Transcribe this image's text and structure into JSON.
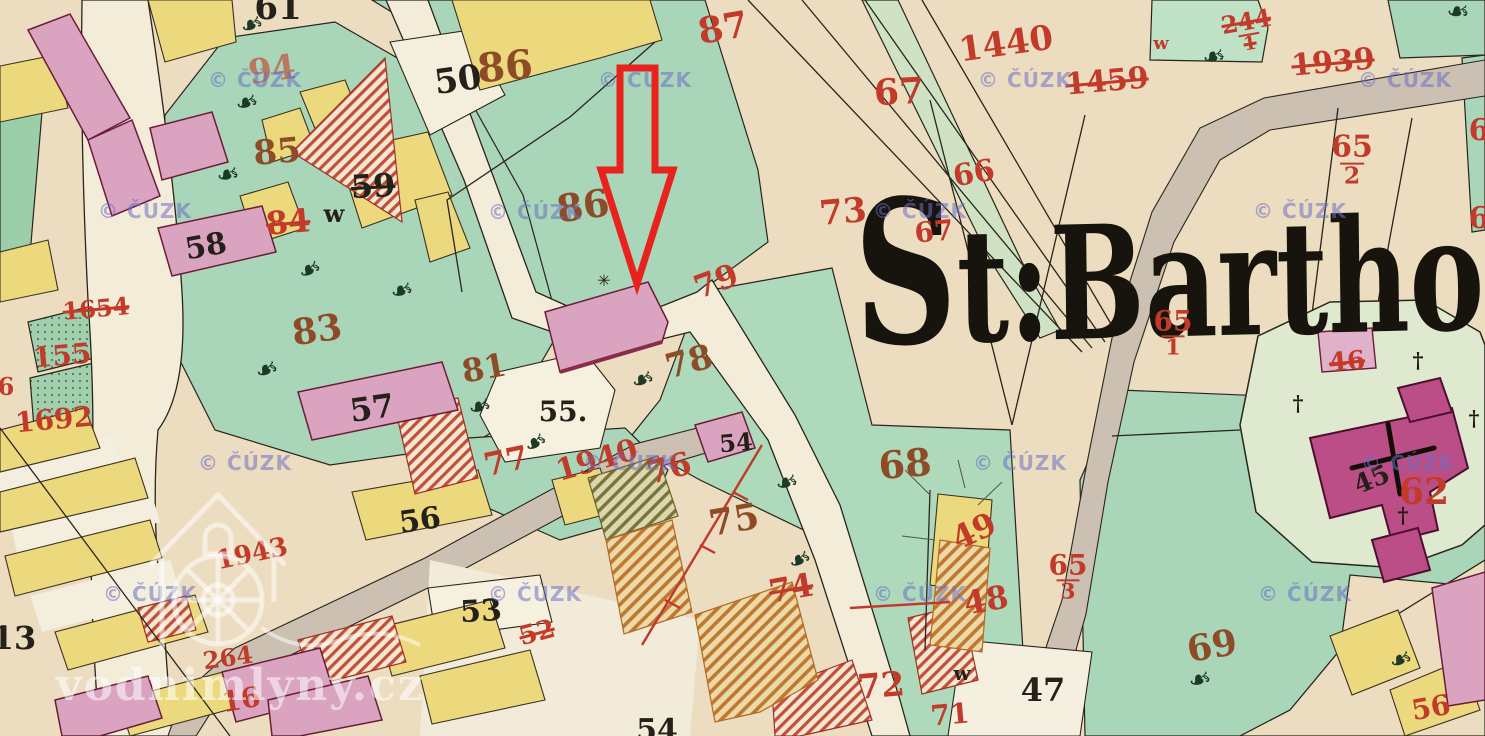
{
  "map": {
    "place_label": "St:Bartho",
    "copyright_watermark": "© ČÚZK",
    "site_watermark": "vodnimlyny.cz",
    "colors": {
      "paper": "#ecdcc0",
      "road_cream": "#f3ecd9",
      "road_grey": "#cbc0b1",
      "meadow_green": "#a9d6b8",
      "churchyard_green": "#dfe9cf",
      "parcel_yellow": "#ecd97d",
      "building_pink": "#daa3c0",
      "church_magenta": "#bb4e86",
      "number_red": "#c23a2a",
      "number_brown": "#8e4b28",
      "ink_black": "#24201a",
      "arrow_red": "#e8231d",
      "watermark_purple": "rgba(108,112,198,0.55)",
      "watermark_white": "rgba(255,255,255,0.55)"
    },
    "arrow": {
      "points": "620,68 655,68 655,170 673,170 637,284 601,170 620,170",
      "color": "#e8231d",
      "stroke_width": 7
    },
    "sun_symbol": {
      "x": 604,
      "y": 281
    },
    "icons": {
      "tree_glyph": "❧",
      "cross_glyph": "†",
      "sun_glyph": "✳"
    },
    "watermark_positions": [
      [
        255,
        80
      ],
      [
        645,
        80
      ],
      [
        1025,
        80
      ],
      [
        1405,
        80
      ],
      [
        145,
        211
      ],
      [
        535,
        212
      ],
      [
        920,
        211
      ],
      [
        1300,
        211
      ],
      [
        245,
        463
      ],
      [
        630,
        463
      ],
      [
        1020,
        463
      ],
      [
        1408,
        463
      ],
      [
        150,
        594
      ],
      [
        535,
        594
      ],
      [
        920,
        594
      ],
      [
        1305,
        594
      ]
    ],
    "labels": [
      {
        "text": "61",
        "x": 278,
        "y": 8,
        "color": "black",
        "size": 34,
        "rot": 0
      },
      {
        "text": "50",
        "x": 458,
        "y": 80,
        "color": "black",
        "size": 34,
        "rot": -8
      },
      {
        "text": "94",
        "x": 272,
        "y": 70,
        "color": "red",
        "size": 34,
        "rot": -8,
        "fade": true
      },
      {
        "text": "85",
        "x": 277,
        "y": 152,
        "color": "brown",
        "size": 34,
        "rot": -5
      },
      {
        "text": "59",
        "x": 373,
        "y": 186,
        "color": "black",
        "size": 32,
        "rot": -3,
        "strike": true
      },
      {
        "text": "84",
        "x": 288,
        "y": 222,
        "color": "red",
        "size": 32,
        "rot": -5,
        "strike": true
      },
      {
        "text": "w",
        "x": 334,
        "y": 214,
        "color": "black",
        "size": 24,
        "rot": 0
      },
      {
        "text": "58",
        "x": 206,
        "y": 247,
        "color": "black",
        "size": 30,
        "rot": -10
      },
      {
        "text": "83",
        "x": 317,
        "y": 330,
        "color": "brown",
        "size": 36,
        "rot": -8
      },
      {
        "text": "81",
        "x": 484,
        "y": 368,
        "color": "brown",
        "size": 32,
        "rot": -10
      },
      {
        "text": "57",
        "x": 372,
        "y": 408,
        "color": "black",
        "size": 32,
        "rot": -8
      },
      {
        "text": "55.",
        "x": 563,
        "y": 412,
        "color": "black",
        "size": 28,
        "rot": 0
      },
      {
        "text": "54",
        "x": 736,
        "y": 443,
        "color": "black",
        "size": 24,
        "rot": -5
      },
      {
        "text": "86",
        "x": 505,
        "y": 67,
        "color": "brown",
        "size": 40,
        "rot": -5
      },
      {
        "text": "86",
        "x": 583,
        "y": 206,
        "color": "brown",
        "size": 38,
        "rot": -8
      },
      {
        "text": "87",
        "x": 723,
        "y": 28,
        "color": "red",
        "size": 36,
        "rot": -10
      },
      {
        "text": "79",
        "x": 716,
        "y": 281,
        "color": "red",
        "size": 32,
        "rot": -20
      },
      {
        "text": "78",
        "x": 689,
        "y": 362,
        "color": "brown",
        "size": 34,
        "rot": -15
      },
      {
        "text": "75",
        "x": 734,
        "y": 520,
        "color": "brown",
        "size": 36,
        "rot": -10
      },
      {
        "text": "76",
        "x": 669,
        "y": 468,
        "color": "red",
        "size": 32,
        "rot": -15
      },
      {
        "text": "77",
        "x": 506,
        "y": 461,
        "color": "red",
        "size": 32,
        "rot": -12
      },
      {
        "text": "74",
        "x": 791,
        "y": 588,
        "color": "red",
        "size": 32,
        "rot": -10,
        "strike": true
      },
      {
        "text": "1940",
        "x": 597,
        "y": 461,
        "color": "red",
        "size": 30,
        "rot": -16
      },
      {
        "text": "73",
        "x": 843,
        "y": 212,
        "color": "red",
        "size": 34,
        "rot": -5
      },
      {
        "text": "66",
        "x": 974,
        "y": 174,
        "color": "red",
        "size": 30,
        "rot": -10
      },
      {
        "text": "67",
        "x": 899,
        "y": 92,
        "color": "red",
        "size": 36,
        "rot": -3
      },
      {
        "text": "67",
        "x": 934,
        "y": 232,
        "color": "red",
        "size": 28,
        "rot": -5
      },
      {
        "text": "1440",
        "x": 1006,
        "y": 44,
        "color": "red",
        "size": 34,
        "rot": -8
      },
      {
        "text": "1459",
        "x": 1107,
        "y": 82,
        "color": "red",
        "size": 30,
        "rot": -5,
        "strike": true
      },
      {
        "text": "w",
        "x": 1161,
        "y": 44,
        "color": "red",
        "size": 18,
        "rot": 0
      },
      {
        "text": "244",
        "den": "1",
        "x": 1248,
        "y": 32,
        "color": "red",
        "size": 24,
        "rot": -10,
        "strike": true
      },
      {
        "text": "1939",
        "x": 1333,
        "y": 63,
        "color": "red",
        "size": 30,
        "rot": -5,
        "strike": true
      },
      {
        "text": "65",
        "den": "2",
        "x": 1352,
        "y": 160,
        "color": "red",
        "size": 30,
        "rot": 0
      },
      {
        "text": "65",
        "den": "1",
        "x": 1173,
        "y": 333,
        "color": "red",
        "size": 28,
        "rot": 0
      },
      {
        "text": "65",
        "den": "3",
        "x": 1068,
        "y": 577,
        "color": "red",
        "size": 28,
        "rot": 0
      },
      {
        "text": "6",
        "x": 1479,
        "y": 131,
        "color": "red",
        "size": 30,
        "rot": 0
      },
      {
        "text": "6",
        "x": 1479,
        "y": 219,
        "color": "red",
        "size": 30,
        "rot": 0
      },
      {
        "text": "62",
        "x": 1424,
        "y": 492,
        "color": "red",
        "size": 36,
        "rot": 0
      },
      {
        "text": "46",
        "x": 1347,
        "y": 362,
        "color": "red",
        "size": 26,
        "rot": -5,
        "strike": true
      },
      {
        "text": "45",
        "x": 1372,
        "y": 480,
        "color": "black",
        "size": 26,
        "rot": -22
      },
      {
        "text": "68",
        "x": 905,
        "y": 464,
        "color": "brown",
        "size": 38,
        "rot": -5
      },
      {
        "text": "49",
        "x": 974,
        "y": 531,
        "color": "red",
        "size": 32,
        "rot": -25
      },
      {
        "text": "48",
        "x": 986,
        "y": 600,
        "color": "red",
        "size": 32,
        "rot": -10
      },
      {
        "text": "72",
        "x": 881,
        "y": 686,
        "color": "red",
        "size": 34,
        "rot": -5
      },
      {
        "text": "71",
        "x": 950,
        "y": 715,
        "color": "red",
        "size": 28,
        "rot": -5
      },
      {
        "text": "w",
        "x": 962,
        "y": 673,
        "color": "black",
        "size": 20,
        "rot": 0
      },
      {
        "text": "47",
        "x": 1043,
        "y": 690,
        "color": "black",
        "size": 32,
        "rot": 0
      },
      {
        "text": "69",
        "x": 1212,
        "y": 646,
        "color": "brown",
        "size": 36,
        "rot": -10
      },
      {
        "text": "56",
        "x": 1431,
        "y": 708,
        "color": "red",
        "size": 28,
        "rot": -10
      },
      {
        "text": "56",
        "x": 420,
        "y": 521,
        "color": "black",
        "size": 30,
        "rot": -8
      },
      {
        "text": "53",
        "x": 481,
        "y": 612,
        "color": "black",
        "size": 30,
        "rot": -3
      },
      {
        "text": "52",
        "x": 537,
        "y": 633,
        "color": "red",
        "size": 26,
        "rot": -15,
        "strike": true
      },
      {
        "text": "54",
        "x": 657,
        "y": 731,
        "color": "black",
        "size": 30,
        "rot": 0
      },
      {
        "text": "13",
        "x": 14,
        "y": 638,
        "color": "black",
        "size": 32,
        "rot": 0
      },
      {
        "text": "16",
        "x": 241,
        "y": 700,
        "color": "red",
        "size": 28,
        "rot": -10
      },
      {
        "text": "264",
        "x": 228,
        "y": 658,
        "color": "red",
        "size": 24,
        "rot": -8
      },
      {
        "text": "1943",
        "x": 252,
        "y": 554,
        "color": "red",
        "size": 26,
        "rot": -12
      },
      {
        "text": "1654",
        "x": 96,
        "y": 309,
        "color": "red",
        "size": 24,
        "rot": -5,
        "strike": true
      },
      {
        "text": "155",
        "x": 62,
        "y": 356,
        "color": "red",
        "size": 28,
        "rot": -5
      },
      {
        "text": "1692",
        "x": 54,
        "y": 420,
        "color": "red",
        "size": 28,
        "rot": -5
      },
      {
        "text": "6",
        "x": 6,
        "y": 387,
        "color": "red",
        "size": 24,
        "rot": 0
      }
    ],
    "trees": [
      [
        252,
        25,
        -20
      ],
      [
        247,
        103,
        -15
      ],
      [
        228,
        175,
        -10
      ],
      [
        310,
        270,
        -25
      ],
      [
        402,
        291,
        -15
      ],
      [
        267,
        370,
        -20
      ],
      [
        480,
        407,
        -15
      ],
      [
        536,
        443,
        -30
      ],
      [
        643,
        380,
        -20
      ],
      [
        787,
        483,
        -15
      ],
      [
        800,
        560,
        -25
      ],
      [
        1200,
        680,
        -15
      ],
      [
        1401,
        660,
        -20
      ],
      [
        1214,
        57,
        -10
      ],
      [
        1458,
        12,
        0
      ]
    ],
    "crosses": [
      [
        1418,
        360
      ],
      [
        1298,
        403
      ],
      [
        1474,
        418
      ],
      [
        1403,
        515
      ]
    ]
  }
}
